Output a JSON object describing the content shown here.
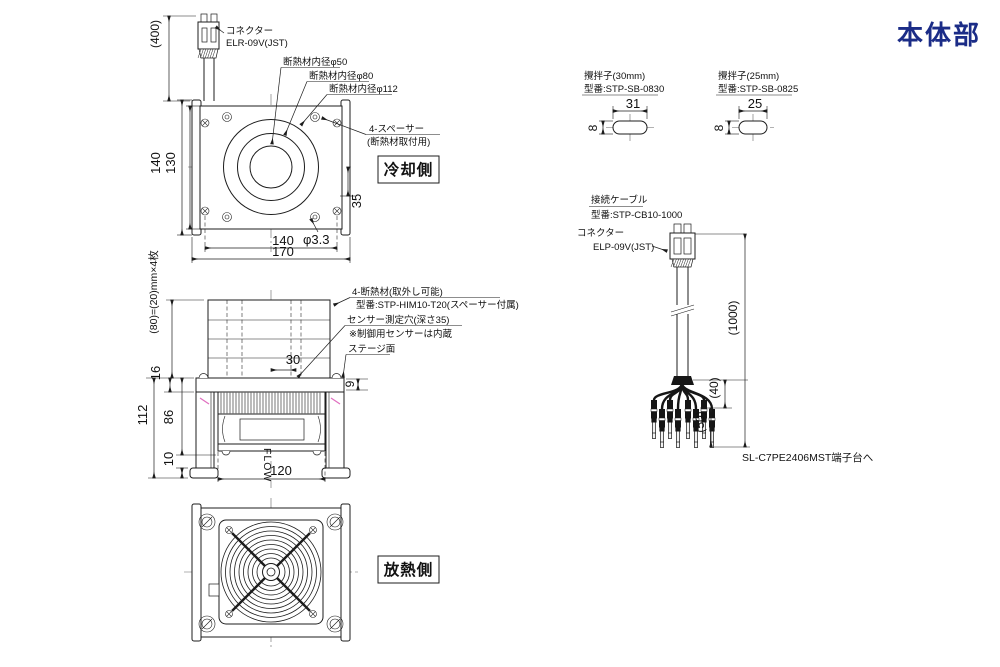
{
  "header": {
    "title": "本体部",
    "title_color": "#1b2c87"
  },
  "cooling_view": {
    "connector_label": "コネクター",
    "connector_model": "ELR-09V(JST)",
    "dim_cable_length": "(400)",
    "insulation_id_50": "断熱材内径φ50",
    "insulation_id_80": "断熱材内径φ80",
    "insulation_id_112": "断熱材内径φ112",
    "spacer_label": "4-スペーサー",
    "spacer_note": "(断熱材取付用)",
    "side_tag": "冷却側",
    "dim_height_outer": "140",
    "dim_height_inner": "130",
    "dim_hole_offset": "35",
    "dim_hole_dia": "φ3.3",
    "dim_width_inner": "140",
    "dim_width_outer": "170"
  },
  "side_view": {
    "insulation_note": "(80)=(20)mm×4枚",
    "label_insulation": "4-断熱材(取外し可能)",
    "label_insulation_model": "型番:STP-HIM10-T20(スペーサー付属)",
    "label_sensor_hole": "センサー測定穴(深さ35)",
    "label_sensor_note": "※制御用センサーは内蔵",
    "label_stage_surface": "ステージ面",
    "dim_sensor_offset": "30",
    "dim_stage_thickness": "16",
    "dim_total_height": "112",
    "dim_body_height": "86",
    "dim_foot_height": "10",
    "dim_lip": "9",
    "flow_label": "FLOW",
    "dim_fan_width": "120"
  },
  "heat_view": {
    "side_tag": "放熱側"
  },
  "stirrer_30": {
    "name": "攪拌子(30mm)",
    "model": "型番:STP-SB-0830",
    "dim_length": "31",
    "dim_width": "8"
  },
  "stirrer_25": {
    "name": "攪拌子(25mm)",
    "model": "型番:STP-SB-0825",
    "dim_length": "25",
    "dim_width": "8"
  },
  "cable": {
    "name": "接続ケーブル",
    "model": "型番:STP-CB10-1000",
    "connector_label": "コネクター",
    "connector_model": "ELP-09V(JST)",
    "dim_length": "(1000)",
    "dim_branch": "(40)",
    "dim_terminal": "(50)",
    "destination": "SL-C7PE2406MST端子台へ"
  }
}
